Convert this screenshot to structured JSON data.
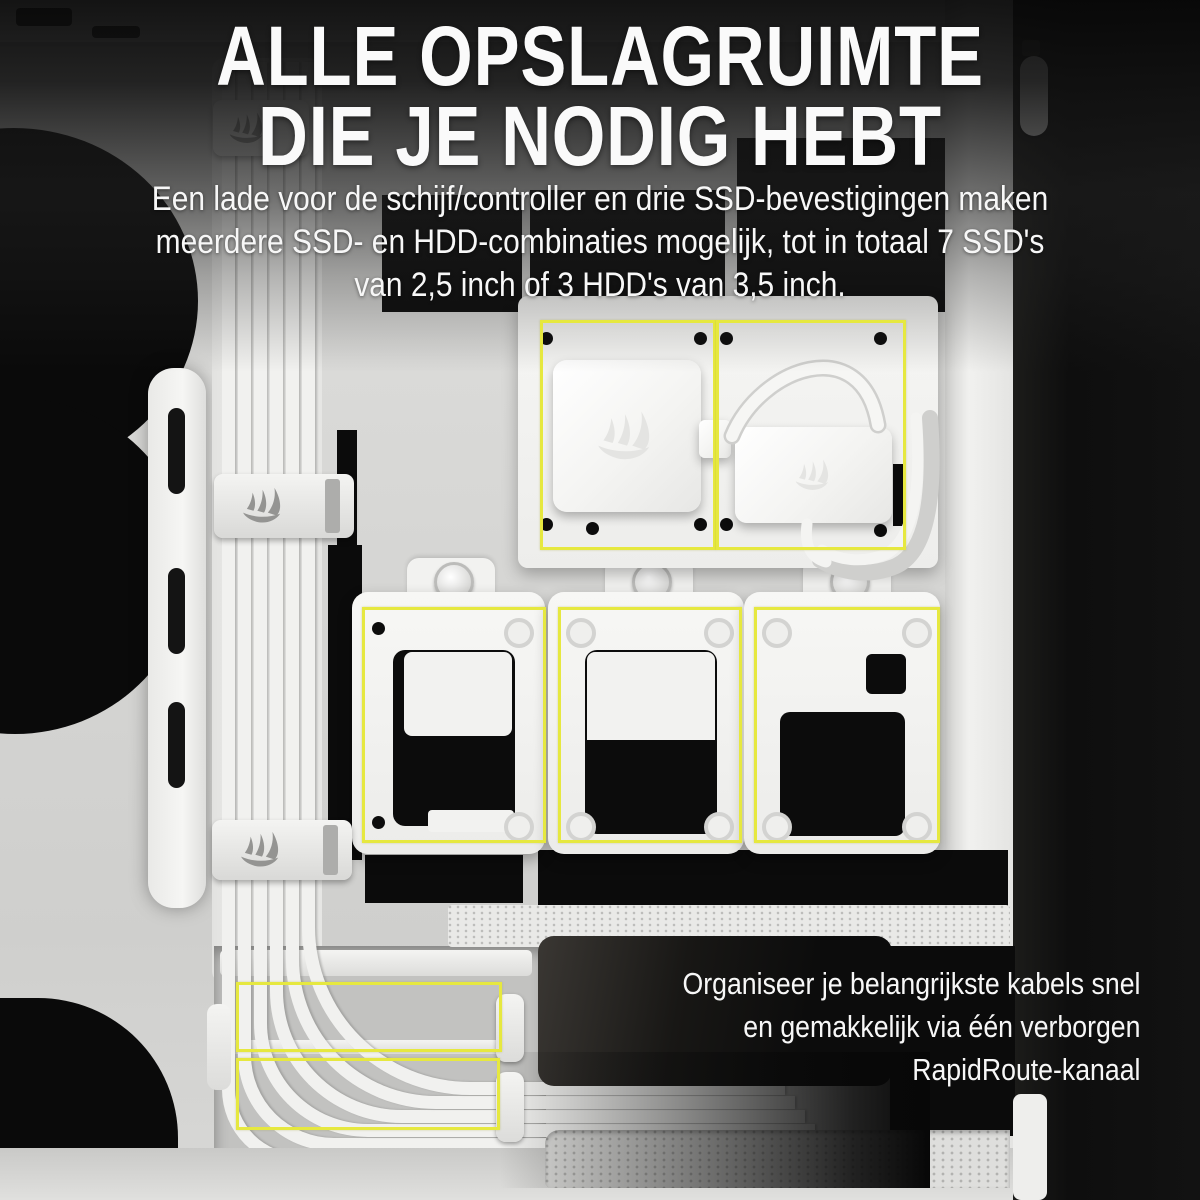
{
  "heading": {
    "line1": "ALLE OPSLAGRUIMTE",
    "line2": "DIE JE NODIG HEBT"
  },
  "intro": {
    "line1": "Een lade voor de schijf/controller en drie SSD-bevestigingen maken",
    "line2": "meerdere SSD- en HDD-combinaties mogelijk, tot in totaal 7 SSD's",
    "line3": "van 2,5 inch of 3 HDD's van 3,5 inch."
  },
  "callout": {
    "line1": "Organiseer je belangrijkste kabels snel",
    "line2": "en gemakkelijk via één verborgen",
    "line3": "RapidRoute-kanaal"
  },
  "icons": {
    "brand_logo": "corsair-sails-logo"
  },
  "colors": {
    "highlight_yellow": "#e6e83f",
    "text_white": "#f7f7f7",
    "case_white": "#f4f4f2",
    "cutout_black": "#0b0b0b",
    "right_band_black": "#101010"
  }
}
